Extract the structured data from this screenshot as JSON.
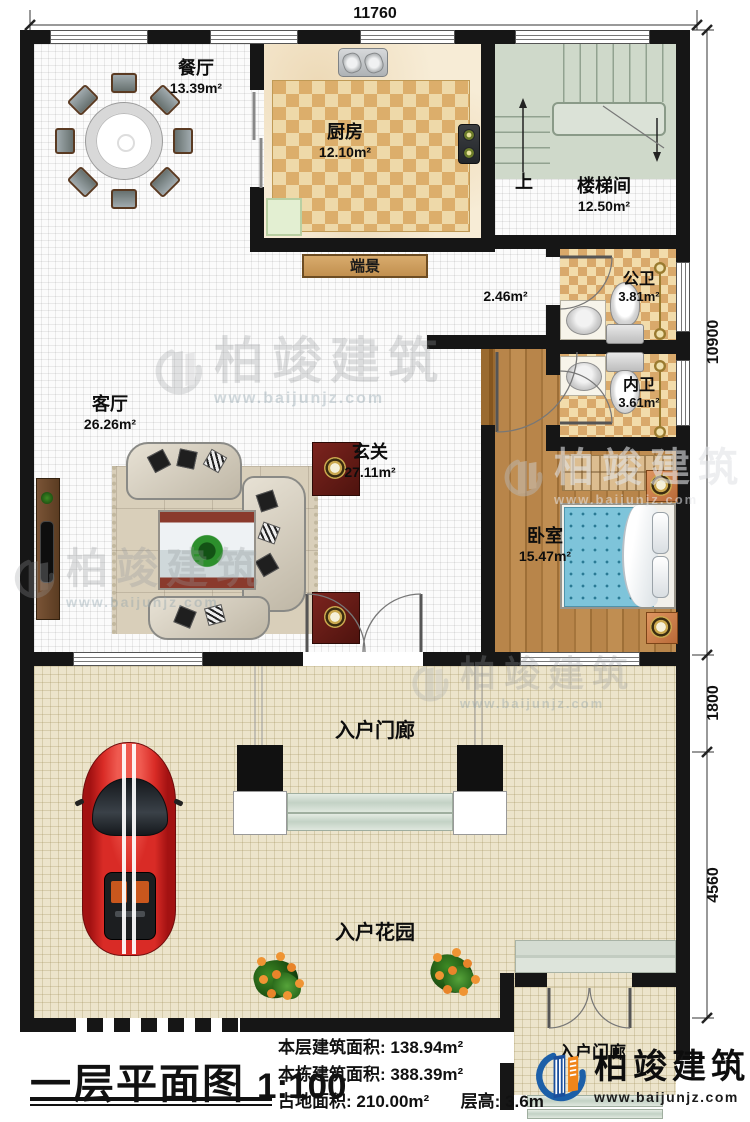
{
  "plan": {
    "dim_top": "11760",
    "dim_right_top": "10900",
    "dim_right_mid": "1800",
    "dim_right_bottom": "4560",
    "rooms": {
      "dining": {
        "name": "餐厅",
        "area": "13.39m²"
      },
      "kitchen": {
        "name": "厨房",
        "area": "12.10m²"
      },
      "stair": {
        "name": "楼梯间",
        "area": "12.50m²"
      },
      "up": "上",
      "console": "端景",
      "hall_area": "2.46m²",
      "public_bath": {
        "name": "公卫",
        "area": "3.81m²"
      },
      "inner_bath": {
        "name": "内卫",
        "area": "3.61m²"
      },
      "living": {
        "name": "客厅",
        "area": "26.26m²"
      },
      "foyer": {
        "name": "玄关",
        "area": "27.11m²"
      },
      "bedroom": {
        "name": "卧室",
        "area": "15.47m²"
      },
      "porch": "入户门廊",
      "garden": "入户花园",
      "porch2": "入户门廊"
    }
  },
  "title_block": {
    "title": "一层平面图",
    "scale": "1:100",
    "stat1_label": "本层建筑面积:",
    "stat1_value": "138.94m²",
    "stat2_label": "本栋建筑面积:",
    "stat2_value": "388.39m²",
    "stat3_label": "占地面积:",
    "stat3_value": "210.00m²",
    "stat4_label": "层高:",
    "stat4_value": "3.6m"
  },
  "brand": {
    "name": "柏竣建筑",
    "url": "www.baijunjz.com"
  },
  "colors": {
    "wall": "#161616",
    "checker_tan": "#d8a96b",
    "floor_cream": "#ece4cb",
    "stair_sage": "#cfd9ca",
    "bedroom_wood": "#ad7b40",
    "bed_blue": "#7ec4da",
    "car_red": "#c42020",
    "brand_blue": "#1c5fa8",
    "brand_orange": "#f08519"
  }
}
